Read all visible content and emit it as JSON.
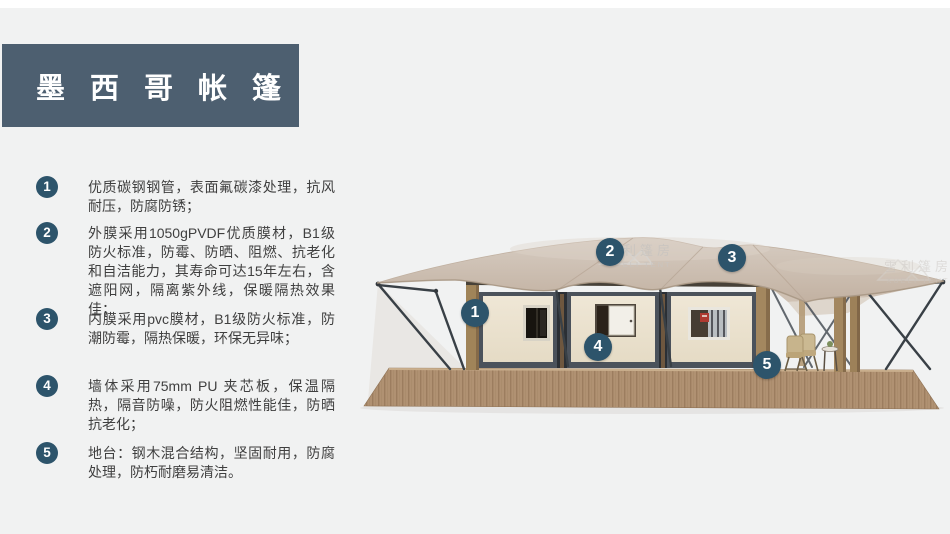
{
  "title": {
    "text": "墨西哥帐篷"
  },
  "features": [
    {
      "num": "1",
      "text": "优质碳钢钢管，表面氟碳漆处理，抗风耐压，防腐防锈；"
    },
    {
      "num": "2",
      "text": "外膜采用1050gPVDF优质膜材，B1级防火标准，防霉、防晒、阻燃、抗老化和自洁能力，其寿命可达15年左右，含遮阳网，隔离紫外线，保暖隔热效果佳；"
    },
    {
      "num": "3",
      "text": "内膜采用pvc膜材，B1级防火标准，防潮防霉，隔热保暖，环保无异味；"
    },
    {
      "num": "4",
      "text": "墙体采用75mm PU 夹芯板，保温隔热，隔音防噪，防火阻燃性能佳，防晒抗老化；"
    },
    {
      "num": "5",
      "text": "地台：钢木混合结构，坚固耐用，防腐处理，防朽耐磨易清洁。"
    }
  ],
  "callouts": [
    {
      "num": "1"
    },
    {
      "num": "2"
    },
    {
      "num": "3"
    },
    {
      "num": "4"
    },
    {
      "num": "5"
    }
  ],
  "watermark": {
    "cn": "雪利篷房",
    "en": "XUELI TENT"
  },
  "colors": {
    "page-bg": "#f1f2f2",
    "banner": "#4d5f70",
    "badge": "#2d546b",
    "text": "#3f3f3f",
    "roof": "#cdbfb2",
    "wall": "#ece3d0",
    "wall-frame": "#4b525b",
    "deck": "#b09172",
    "steel": "#3b4147",
    "wood-post": "#a3875f"
  }
}
